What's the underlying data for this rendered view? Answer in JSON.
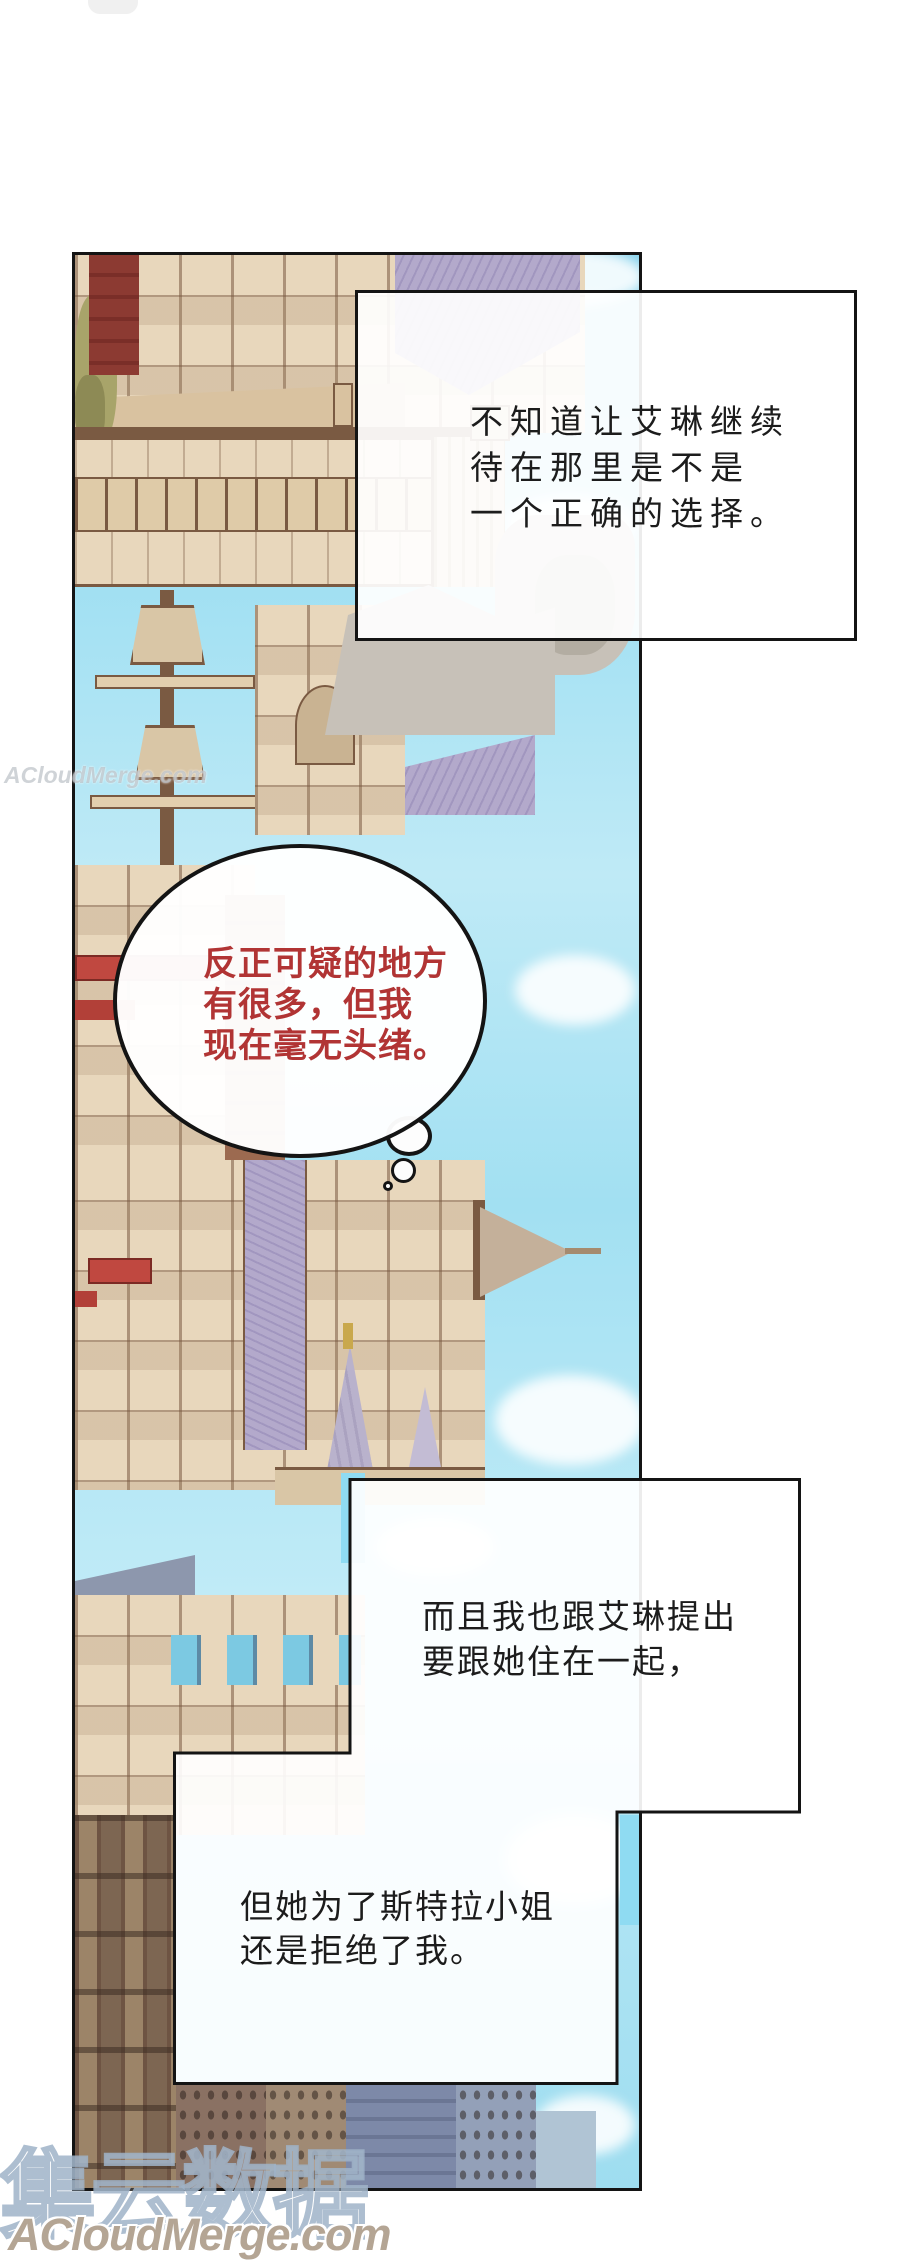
{
  "page_type": "webtoon-comic-page",
  "top_box": {
    "lines": [
      "不知道让艾琳继续",
      "待在那里是不是",
      "一个正确的选择。"
    ]
  },
  "thought_bubble": {
    "lines": [
      "反正可疑的地方",
      "有很多，但我",
      "现在毫无头绪。"
    ],
    "text_color": "#b13434"
  },
  "middle_box": {
    "lines": [
      "而且我也跟艾琳提出",
      "要跟她住在一起，"
    ]
  },
  "bottom_box": {
    "lines": [
      "但她为了斯特拉小姐",
      "还是拒绝了我。"
    ]
  },
  "watermarks": {
    "side": "ACloudMerge.com",
    "bottom_cn": "集云数据",
    "bottom_en": "ACloudMerge.com"
  },
  "palette": {
    "sky": "#9ad9ee",
    "sky-light": "#c6eef8",
    "cyan-bright": "#8fdbf2",
    "beige": "#e8d7bc",
    "beige-dark": "#d9c2a0",
    "brown": "#7a5a42",
    "brown-dark": "#5b4334",
    "mauve": "#b3a9cb",
    "mauve-dark": "#a196bf",
    "red": "#c04840",
    "maroon": "#8c3a32",
    "rock": "#c7c1b8",
    "rock-dark": "#b3ada2",
    "slate": "#7d89a8",
    "dark-wood": "#755c49",
    "ink": "#1c1c1c",
    "bubble-red": "#b13434",
    "wm-gray": "#b4a594"
  }
}
